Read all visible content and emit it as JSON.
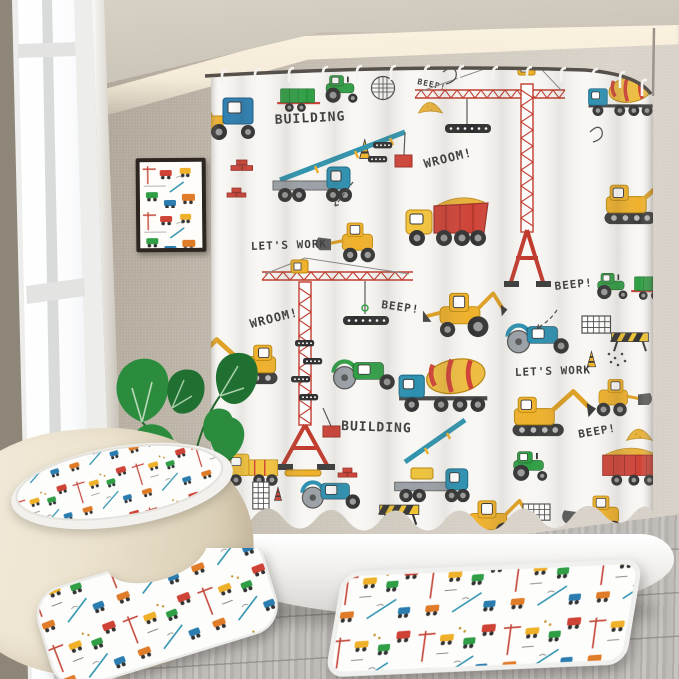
{
  "curtain": {
    "theme": "construction-vehicles-print",
    "labels": [
      {
        "id": "building-top",
        "text": "BUILDING"
      },
      {
        "id": "wroom-top",
        "text": "WROOM!"
      },
      {
        "id": "lets-work-left",
        "text": "LET'S WORK"
      },
      {
        "id": "beep-center",
        "text": "BEEP!"
      },
      {
        "id": "wroom-mid",
        "text": "WROOM!"
      },
      {
        "id": "beep-right",
        "text": "BEEP!"
      },
      {
        "id": "lets-work-right",
        "text": "LET'S WORK"
      },
      {
        "id": "building-bottom",
        "text": "BUILDING"
      },
      {
        "id": "beep-bottom",
        "text": "BEEP!"
      },
      {
        "id": "beep-top-edge",
        "text": "BEEP!"
      }
    ],
    "vehicle_icons": [
      "tower-crane-icon",
      "dump-truck-icon",
      "cement-mixer-icon",
      "excavator-icon",
      "backhoe-loader-icon",
      "wheel-loader-icon",
      "road-roller-icon",
      "tractor-trailer-icon",
      "crane-truck-icon",
      "box-truck-icon",
      "sand-pile-icon",
      "traffic-cone-icon",
      "bricks-icon",
      "safety-barrier-icon",
      "grid-doodle-icon",
      "steel-beam-icon"
    ]
  },
  "room": {
    "items": [
      "window",
      "framed-art",
      "monstera-plant",
      "shower-rod",
      "shower-hooks",
      "shower-curtain",
      "bathtub",
      "toilet-with-lid-cover",
      "contour-mat",
      "rectangle-bath-mat",
      "wood-floor"
    ]
  },
  "colors": {
    "curtain_base": "#f8f7f4",
    "red": "#cf4236",
    "yellow": "#efb02a",
    "green": "#2f9e44",
    "teal": "#2f93ad",
    "blue": "#2b7db0",
    "outline": "#3a3a3a",
    "wall_left": "#a29a8d",
    "wall_right": "#d5cfc6",
    "floor_gray": "#b5b1ae",
    "toilet_cream": "#ece3cf"
  }
}
